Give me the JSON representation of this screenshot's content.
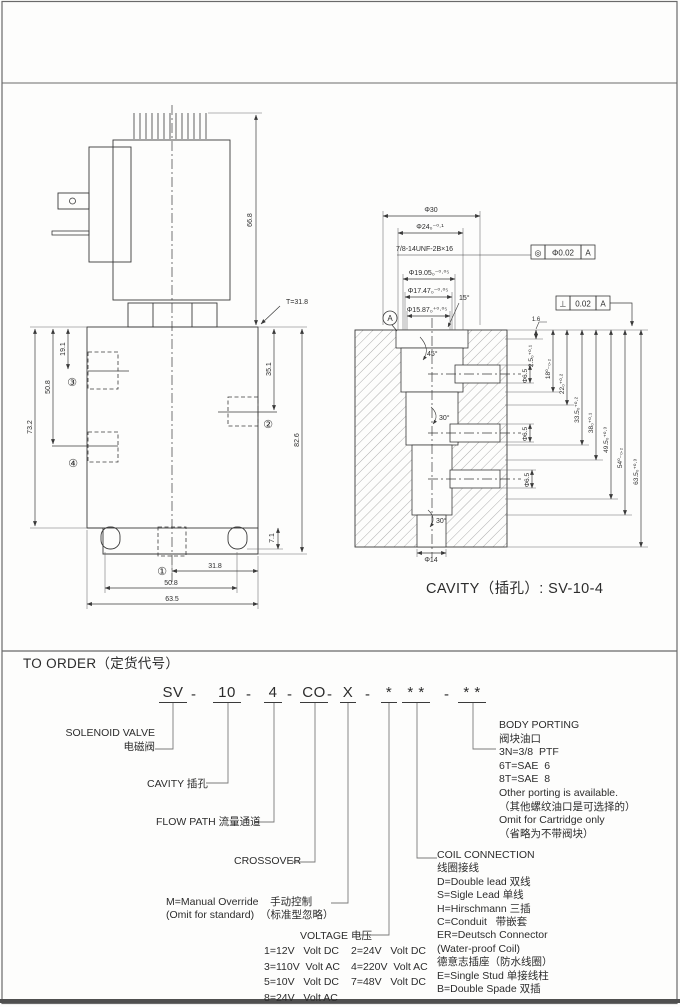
{
  "outline": {
    "dims": {
      "coil_height": "66.8",
      "thread_note": "T=31.8",
      "port3_depth": "19.1",
      "left_50_8": "50.8",
      "body_height": "73.2",
      "port2_depth": "35.1",
      "total_height": "82.6",
      "slot_depth": "7.1",
      "bottom_31_8": "31.8",
      "bottom_50_8": "50.8",
      "bottom_63_5": "63.5"
    },
    "ports": {
      "p1": "①",
      "p2": "②",
      "p3": "③",
      "p4": "④"
    }
  },
  "cavity": {
    "caption": "CAVITY（插孔）: SV-10-4",
    "dims": {
      "d30": "Φ30",
      "d24": "Φ24₀⁻⁰·¹",
      "thread": "7/8-14UNF-2B×16",
      "d19_05": "Φ19.05₀⁻⁰·⁰⁵",
      "d17_47": "Φ17.47₀⁻⁰·⁰⁵",
      "d15_87": "Φ15.87₀⁺⁰·⁰⁵",
      "angle15": "15°",
      "angle45": "45°",
      "angle30_upper": "30°",
      "angle30_lower": "30°",
      "depth2_5": "2.5₀⁺⁰·¹",
      "depth18": "18⁰₋₀.₂",
      "depth22": "22₀⁺⁰·²",
      "depth33_5": "33.5₀⁺⁰·²",
      "depth38": "38₀⁺⁰·¹",
      "depth49_5": "49.5₀⁺⁰·³",
      "depth54": "54⁰₋₀.₂",
      "depth63_5": "63.5₀⁺⁰·³",
      "d6_5": "Φ6.5",
      "d14": "Φ14",
      "finish": "1.6"
    },
    "fcf_concentric": {
      "symbol": "◎",
      "tolerance": "Φ0.02",
      "datum": "A"
    },
    "fcf_perpendicular": {
      "symbol": "⊥",
      "tolerance": "0.02",
      "datum": "A"
    },
    "datum_label": "A"
  },
  "order": {
    "title": "TO ORDER（定货代号）",
    "dash": "-",
    "code_tokens": [
      "SV",
      "10",
      "4",
      "CO",
      "X",
      "*",
      "* *",
      "* *"
    ],
    "solenoid_valve_label_en": "SOLENOID VALVE",
    "solenoid_valve_label_cn": "电磁阀",
    "cavity_label": "CAVITY 插孔",
    "flow_path_label": "FLOW PATH 流量通道",
    "crossover_label": "CROSSOVER",
    "manual_override_line1": "M=Manual Override    手动控制",
    "manual_override_line2": "(Omit for standard)  （标准型忽略）",
    "voltage_label": "VOLTAGE 电压",
    "voltage_options": [
      "1=12V   Volt DC",
      "2=24V   Volt DC",
      "3=110V  Volt AC",
      "4=220V  Volt AC",
      "5=10V   Volt DC",
      "7=48V   Volt DC",
      "8=24V   Volt AC"
    ],
    "coil_connection": [
      "COIL CONNECTION",
      "线圈接线",
      "D=Double lead 双线",
      "S=Sigle Lead 单线",
      "H=Hirschmann 三插",
      "C=Conduit   带嵌套",
      "ER=Deutsch Connector",
      "(Water-proof Coil)",
      "德意志插座（防水线圈）",
      "E=Single Stud 单接线柱",
      "B=Double Spade 双插"
    ],
    "body_porting": [
      "BODY PORTING",
      "阀块油口",
      "3N=3/8  PTF",
      "6T=SAE  6",
      "8T=SAE  8",
      "Other porting is available.",
      "（其他螺纹油口是可选择的）",
      "Omit for Cartridge only",
      "（省略为不带阀块）"
    ]
  }
}
